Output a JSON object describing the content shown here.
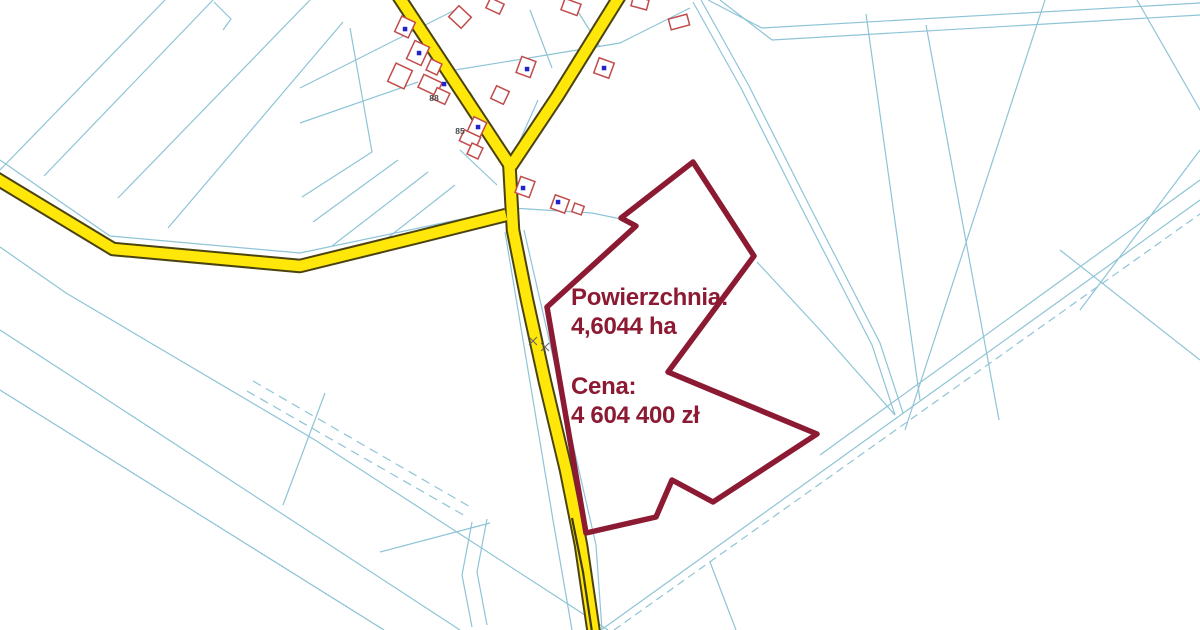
{
  "map": {
    "overlay": {
      "area_label": "Powierzchnia:",
      "area_value": "4,6044 ha",
      "price_label": "Cena:",
      "price_value": "4 604 400 zł"
    },
    "house_numbers": [
      {
        "text": "88"
      },
      {
        "text": "85"
      }
    ],
    "colors": {
      "background": "#ffffff",
      "parcel_line": "#8ec4d6",
      "road_fill": "#ffe70a",
      "road_casing": "#4b430f",
      "road_centerline": "#3f3a10",
      "building_outline": "#c14b4b",
      "building_fill": "#ffffff",
      "building_point": "#2323cc",
      "highlight_boundary": "#8b1a32",
      "overlay_text": "#8b1a32",
      "house_number_text": "#4a4a4a",
      "road_mark": "#666666"
    }
  }
}
